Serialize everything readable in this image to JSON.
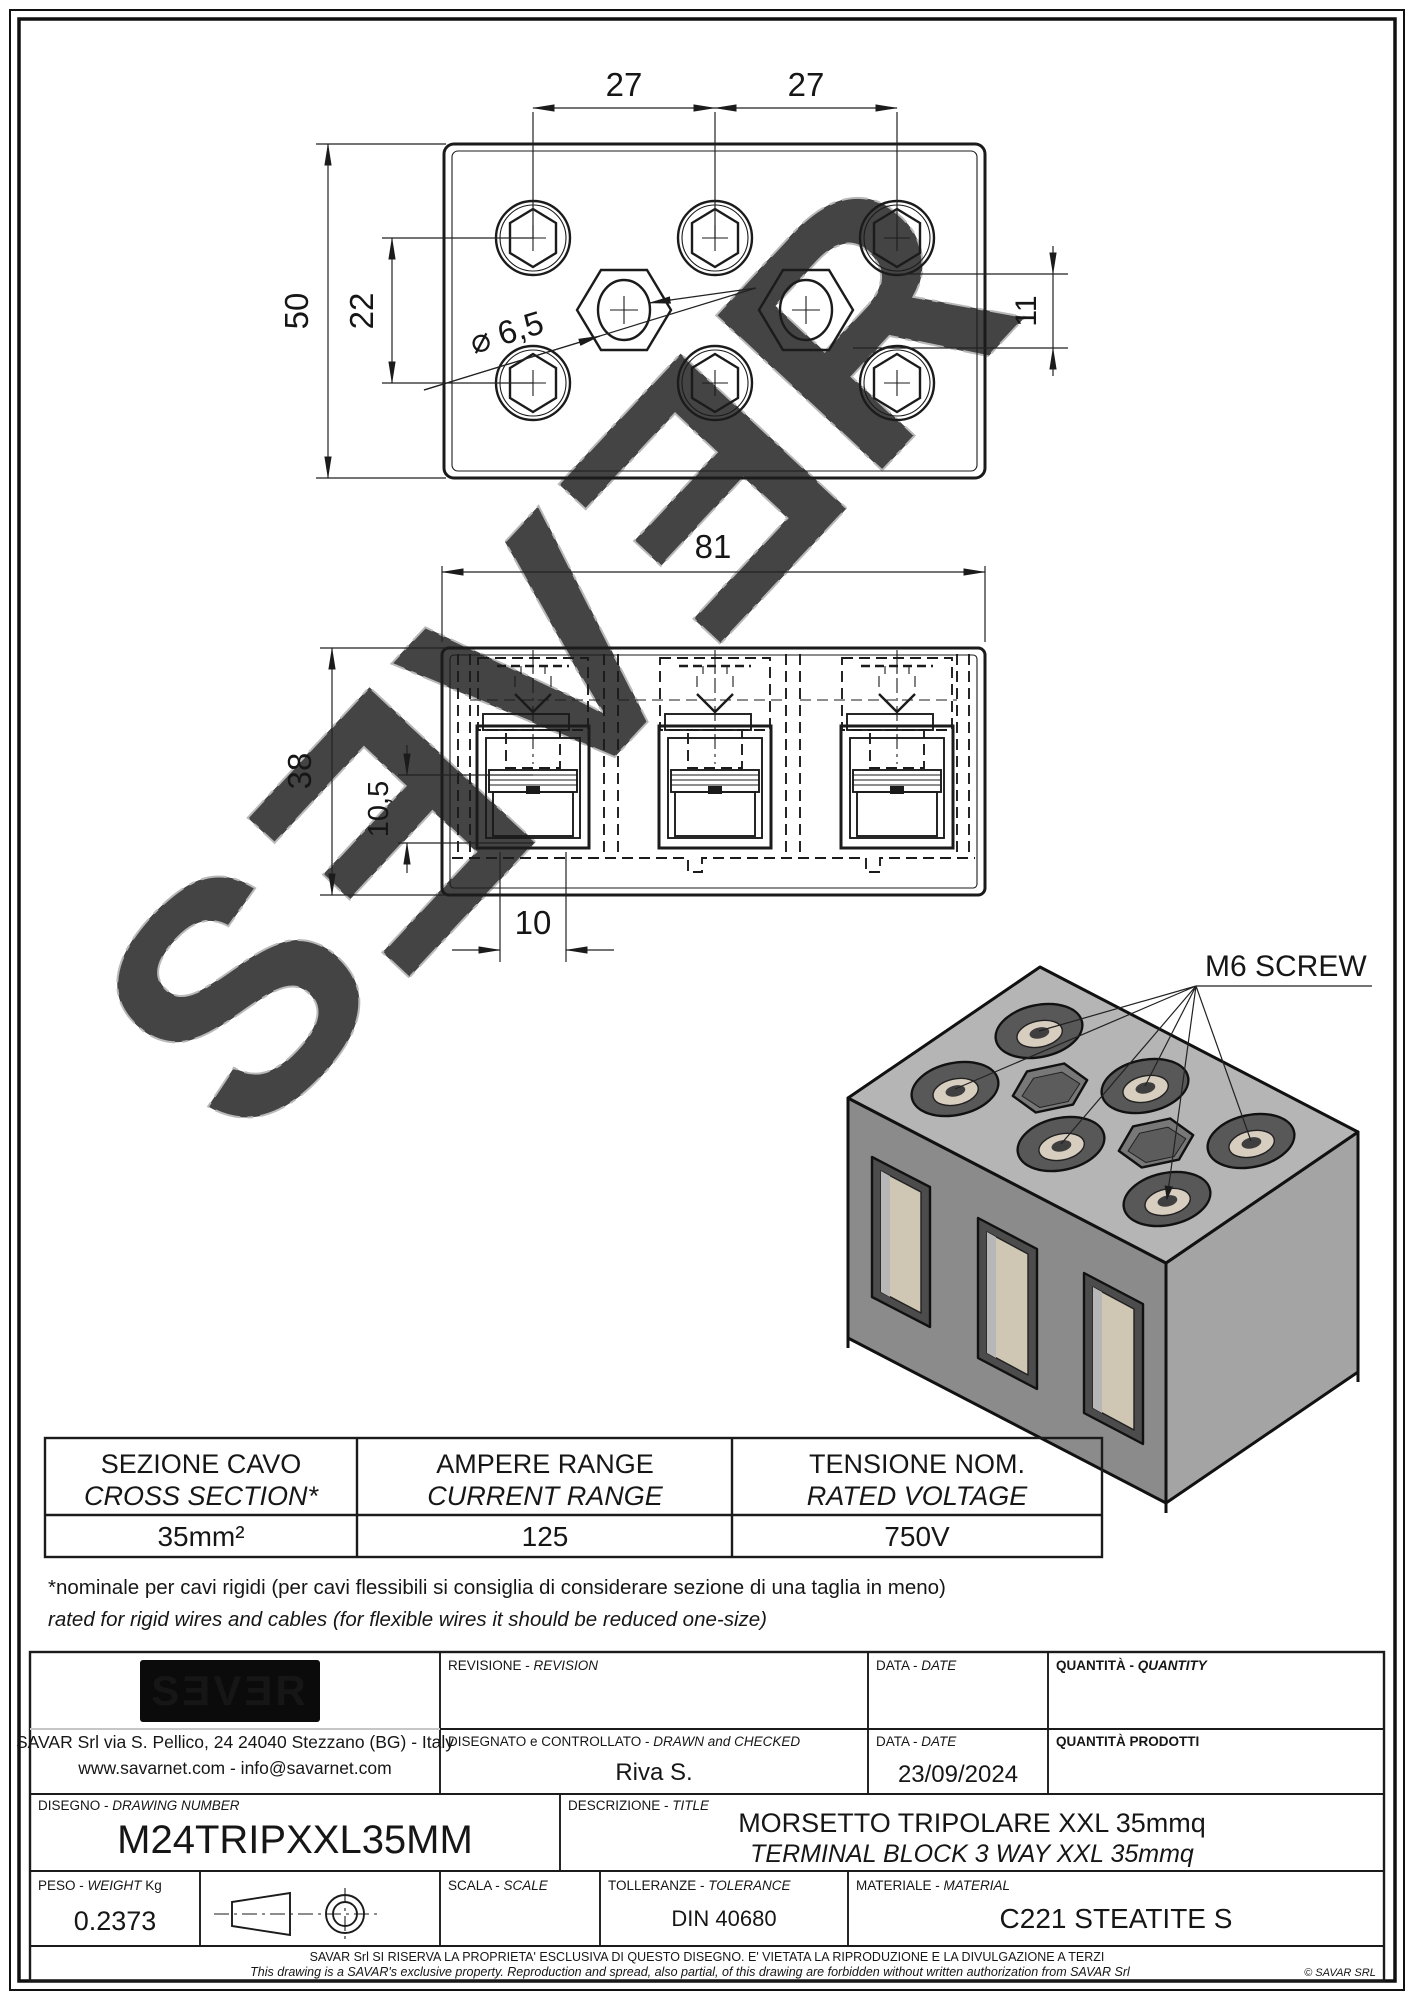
{
  "watermark_text": "SƎVƎR",
  "top_view": {
    "dim_pitch_left": "27",
    "dim_pitch_right": "27",
    "dim_overall_height": "50",
    "dim_row_spacing": "22",
    "dim_hole_diameter": "⌀ 6,5",
    "dim_edge_offset": "11"
  },
  "front_view": {
    "dim_overall_width": "81",
    "dim_overall_height": "38",
    "dim_clamp_depth": "10,5",
    "dim_slot_width": "10"
  },
  "iso_view": {
    "callout": "M6 SCREW"
  },
  "spec_table": {
    "columns": [
      {
        "label_it": "SEZIONE CAVO",
        "label_en": "CROSS SECTION*",
        "value": "35mm²"
      },
      {
        "label_it": "AMPERE RANGE",
        "label_en": "CURRENT RANGE",
        "value": "125"
      },
      {
        "label_it": "TENSIONE NOM.",
        "label_en": "RATED VOLTAGE",
        "value": "750V"
      }
    ]
  },
  "notes": {
    "line_it": "*nominale per cavi rigidi (per cavi flessibili si consiglia di considerare sezione di una taglia in meno)",
    "line_en": "rated for rigid wires and cables (for flexible wires it should be reduced one-size)"
  },
  "title_block": {
    "company": {
      "logo": "SƎVƎR",
      "address_line1": "SAVAR Srl via S. Pellico, 24  24040 Stezzano (BG) - Italy",
      "address_line2": "www.savarnet.com  -  info@savarnet.com"
    },
    "labels": {
      "revision_it": "REVISIONE - ",
      "revision_en": "REVISION",
      "date_it": "DATA - ",
      "date_en": "DATE",
      "quantity_it": "QUANTITÀ - ",
      "quantity_en": "QUANTITY",
      "drawn_it": "DISEGNATO e CONTROLLATO - ",
      "drawn_en": "DRAWN and CHECKED",
      "quantity_prod": "QUANTITÀ  PRODOTTI",
      "drawing_no_it": "DISEGNO - ",
      "drawing_no_en": "DRAWING NUMBER",
      "description_it": "DESCRIZIONE - ",
      "description_en": "TITLE",
      "weight_it": "PESO - ",
      "weight_en": "WEIGHT",
      "weight_unit": " Kg",
      "scale_it": "SCALA - ",
      "scale_en": "SCALE",
      "tolerance_it": "TOLLERANZE - ",
      "tolerance_en": "TOLERANCE",
      "material_it": "MATERIALE - ",
      "material_en": "MATERIAL"
    },
    "values": {
      "drawn_by": "Riva S.",
      "date": "23/09/2024",
      "drawing_number": "M24TRIPXXL35MM",
      "title_it": "MORSETTO TRIPOLARE XXL 35mmq",
      "title_en": "TERMINAL BLOCK 3 WAY  XXL 35mmq",
      "weight": "0.2373",
      "tolerance": "DIN 40680",
      "material": "C221 STEATITE S"
    },
    "footer": {
      "line_it": "SAVAR Srl SI RISERVA LA PROPRIETA' ESCLUSIVA DI QUESTO DISEGNO. E' VIETATA LA RIPRODUZIONE E LA DIVULGAZIONE A TERZI",
      "line_en": "This drawing is a SAVAR's exclusive property. Reproduction and spread, also partial, of this drawing are forbidden without written authorization from SAVAR Srl",
      "copyright": "© SAVAR SRL"
    }
  }
}
